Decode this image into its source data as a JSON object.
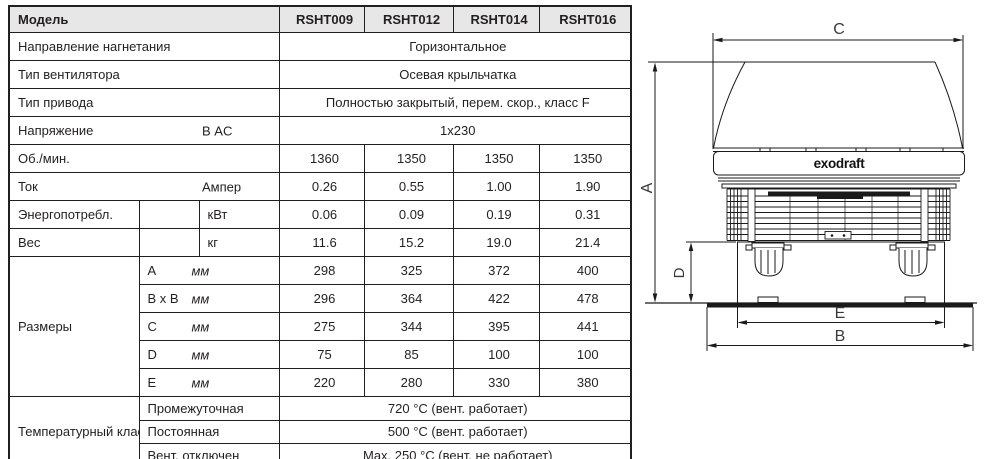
{
  "header": {
    "model_label": "Модель",
    "models": [
      "RSHT009",
      "RSHT012",
      "RSHT014",
      "RSHT016"
    ]
  },
  "rows": {
    "direction": {
      "label": "Направление нагнетания",
      "value": "Горизонтальное"
    },
    "fan_type": {
      "label": "Тип вентилятора",
      "value": "Осевая крыльчатка"
    },
    "drive_type": {
      "label": "Тип привода",
      "value": "Полностью закрытый, перем. скор., класс F"
    },
    "voltage": {
      "label": "Напряжение",
      "unit": "В AC",
      "value": "1x230"
    },
    "rpm": {
      "label": "Об./мин.",
      "values": [
        "1360",
        "1350",
        "1350",
        "1350"
      ]
    },
    "current": {
      "label": "Ток",
      "unit": "Ампер",
      "values": [
        "0.26",
        "0.55",
        "1.00",
        "1.90"
      ]
    },
    "power": {
      "label": "Энергопотребл.",
      "unit": "кВт",
      "values": [
        "0.06",
        "0.09",
        "0.19",
        "0.31"
      ]
    },
    "weight": {
      "label": "Вес",
      "unit": "кг",
      "values": [
        "11.6",
        "15.2",
        "19.0",
        "21.4"
      ]
    }
  },
  "dimensions": {
    "label": "Размеры",
    "unit": "мм",
    "rows": [
      {
        "name": "A",
        "values": [
          "298",
          "325",
          "372",
          "400"
        ]
      },
      {
        "name": "B x B",
        "values": [
          "296",
          "364",
          "422",
          "478"
        ]
      },
      {
        "name": "C",
        "values": [
          "275",
          "344",
          "395",
          "441"
        ]
      },
      {
        "name": "D",
        "values": [
          "75",
          "85",
          "100",
          "100"
        ]
      },
      {
        "name": "E",
        "values": [
          "220",
          "280",
          "330",
          "380"
        ]
      }
    ]
  },
  "temperature": {
    "label": "Температурный класс",
    "rows": [
      {
        "name": "Промежуточная",
        "value": "720 °C (вент. работает)"
      },
      {
        "name": "Постоянная",
        "value": "500 °C (вент. работает)"
      },
      {
        "name": "Вент. отключен",
        "value": "Max. 250 °C (вент. не работает)"
      }
    ]
  },
  "diagram": {
    "brand": "exodraft",
    "dim_labels": {
      "c": "C",
      "a": "A",
      "d": "D",
      "e": "E",
      "b": "B"
    }
  },
  "colors": {
    "border": "#231f20",
    "header_bg": "#e7e7e8",
    "line": "#1a1a1a"
  }
}
